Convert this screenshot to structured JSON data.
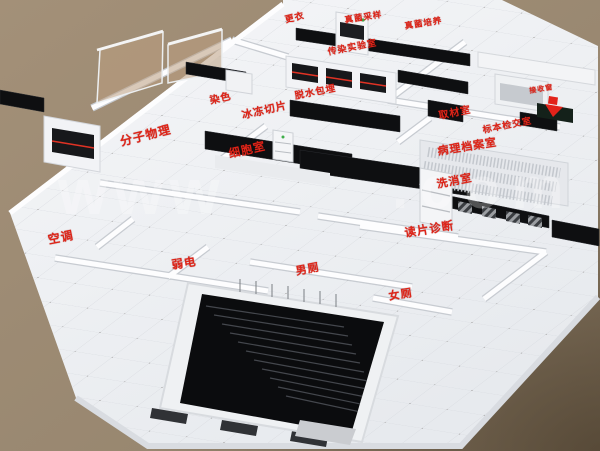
{
  "title": "laboratory-3d-floorplan-render",
  "labels": {
    "changing_room": "更衣",
    "fungus_sampling": "真菌采样",
    "fungus_culture": "真菌培养",
    "infection_lab": "传染实验室",
    "staining": "染色",
    "dehydration_embedding": "脱水包埋",
    "frozen_section": "冰冻切片",
    "molecular_room": "分子物理",
    "cell_room": "细胞室",
    "receiving_window": "接收窗",
    "grossing_room": "取材室",
    "specimen_check_room": "标本检交室",
    "pathology_archive": "病理档案室",
    "washing_room": "洗消室",
    "slide_reading": "读片诊断",
    "hvac_room": "空调",
    "low_voltage_room": "弱电",
    "mens_toilet": "男厕",
    "womens_toilet": "女厕"
  },
  "watermark": {
    "left": "www",
    "right": ".com"
  },
  "colors": {
    "label_red": "#de2418",
    "background_brown": "#9a8973",
    "background_dark_corner": "#6f6049",
    "floor_white": "#eef0f3",
    "bench_black": "#0e0f11",
    "glass_tint": "#bb9e80",
    "green_indicator": "#3fae4a",
    "watermark_white": "#ffffff"
  }
}
